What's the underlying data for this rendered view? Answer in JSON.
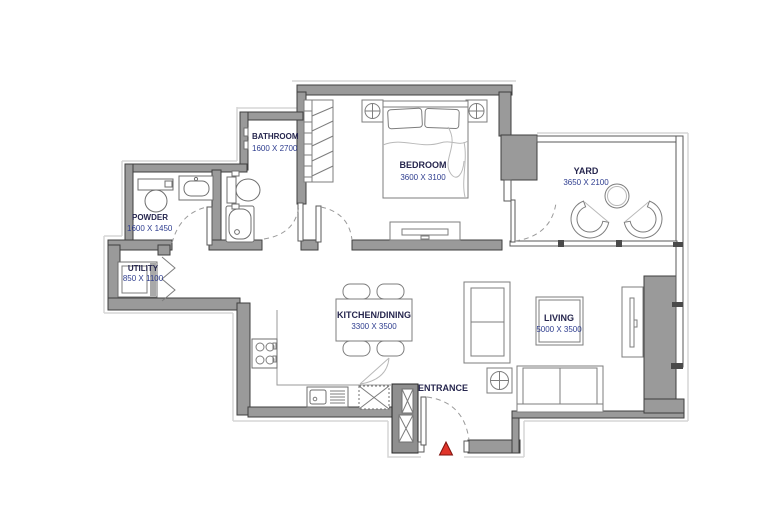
{
  "rooms": [
    {
      "name": "POWDER",
      "dims": "1600 X 1450"
    },
    {
      "name": "BATHROOM",
      "dims": "1600 X 2700"
    },
    {
      "name": "BEDROOM",
      "dims": "3600 X 3100"
    },
    {
      "name": "YARD",
      "dims": "3650 X 2100"
    },
    {
      "name": "UTILITY",
      "dims": "850 X 1100"
    },
    {
      "name": "KITCHEN/DINING",
      "dims": "3300 X 3500"
    },
    {
      "name": "LIVING",
      "dims": "5000 X 3500"
    }
  ],
  "entrance": {
    "label": "ENTRANCE"
  },
  "colors": {
    "wall_fill": "#9a9a9a",
    "wall_stroke": "#3f3f3f",
    "room_name": "#26264e",
    "room_dims": "#2e3d8f",
    "door_arc": "#9a9a9a",
    "furniture_line": "#7d7d7d",
    "entrance_marker_fill": "#e0352b",
    "entrance_marker_stroke": "#7e120d"
  }
}
